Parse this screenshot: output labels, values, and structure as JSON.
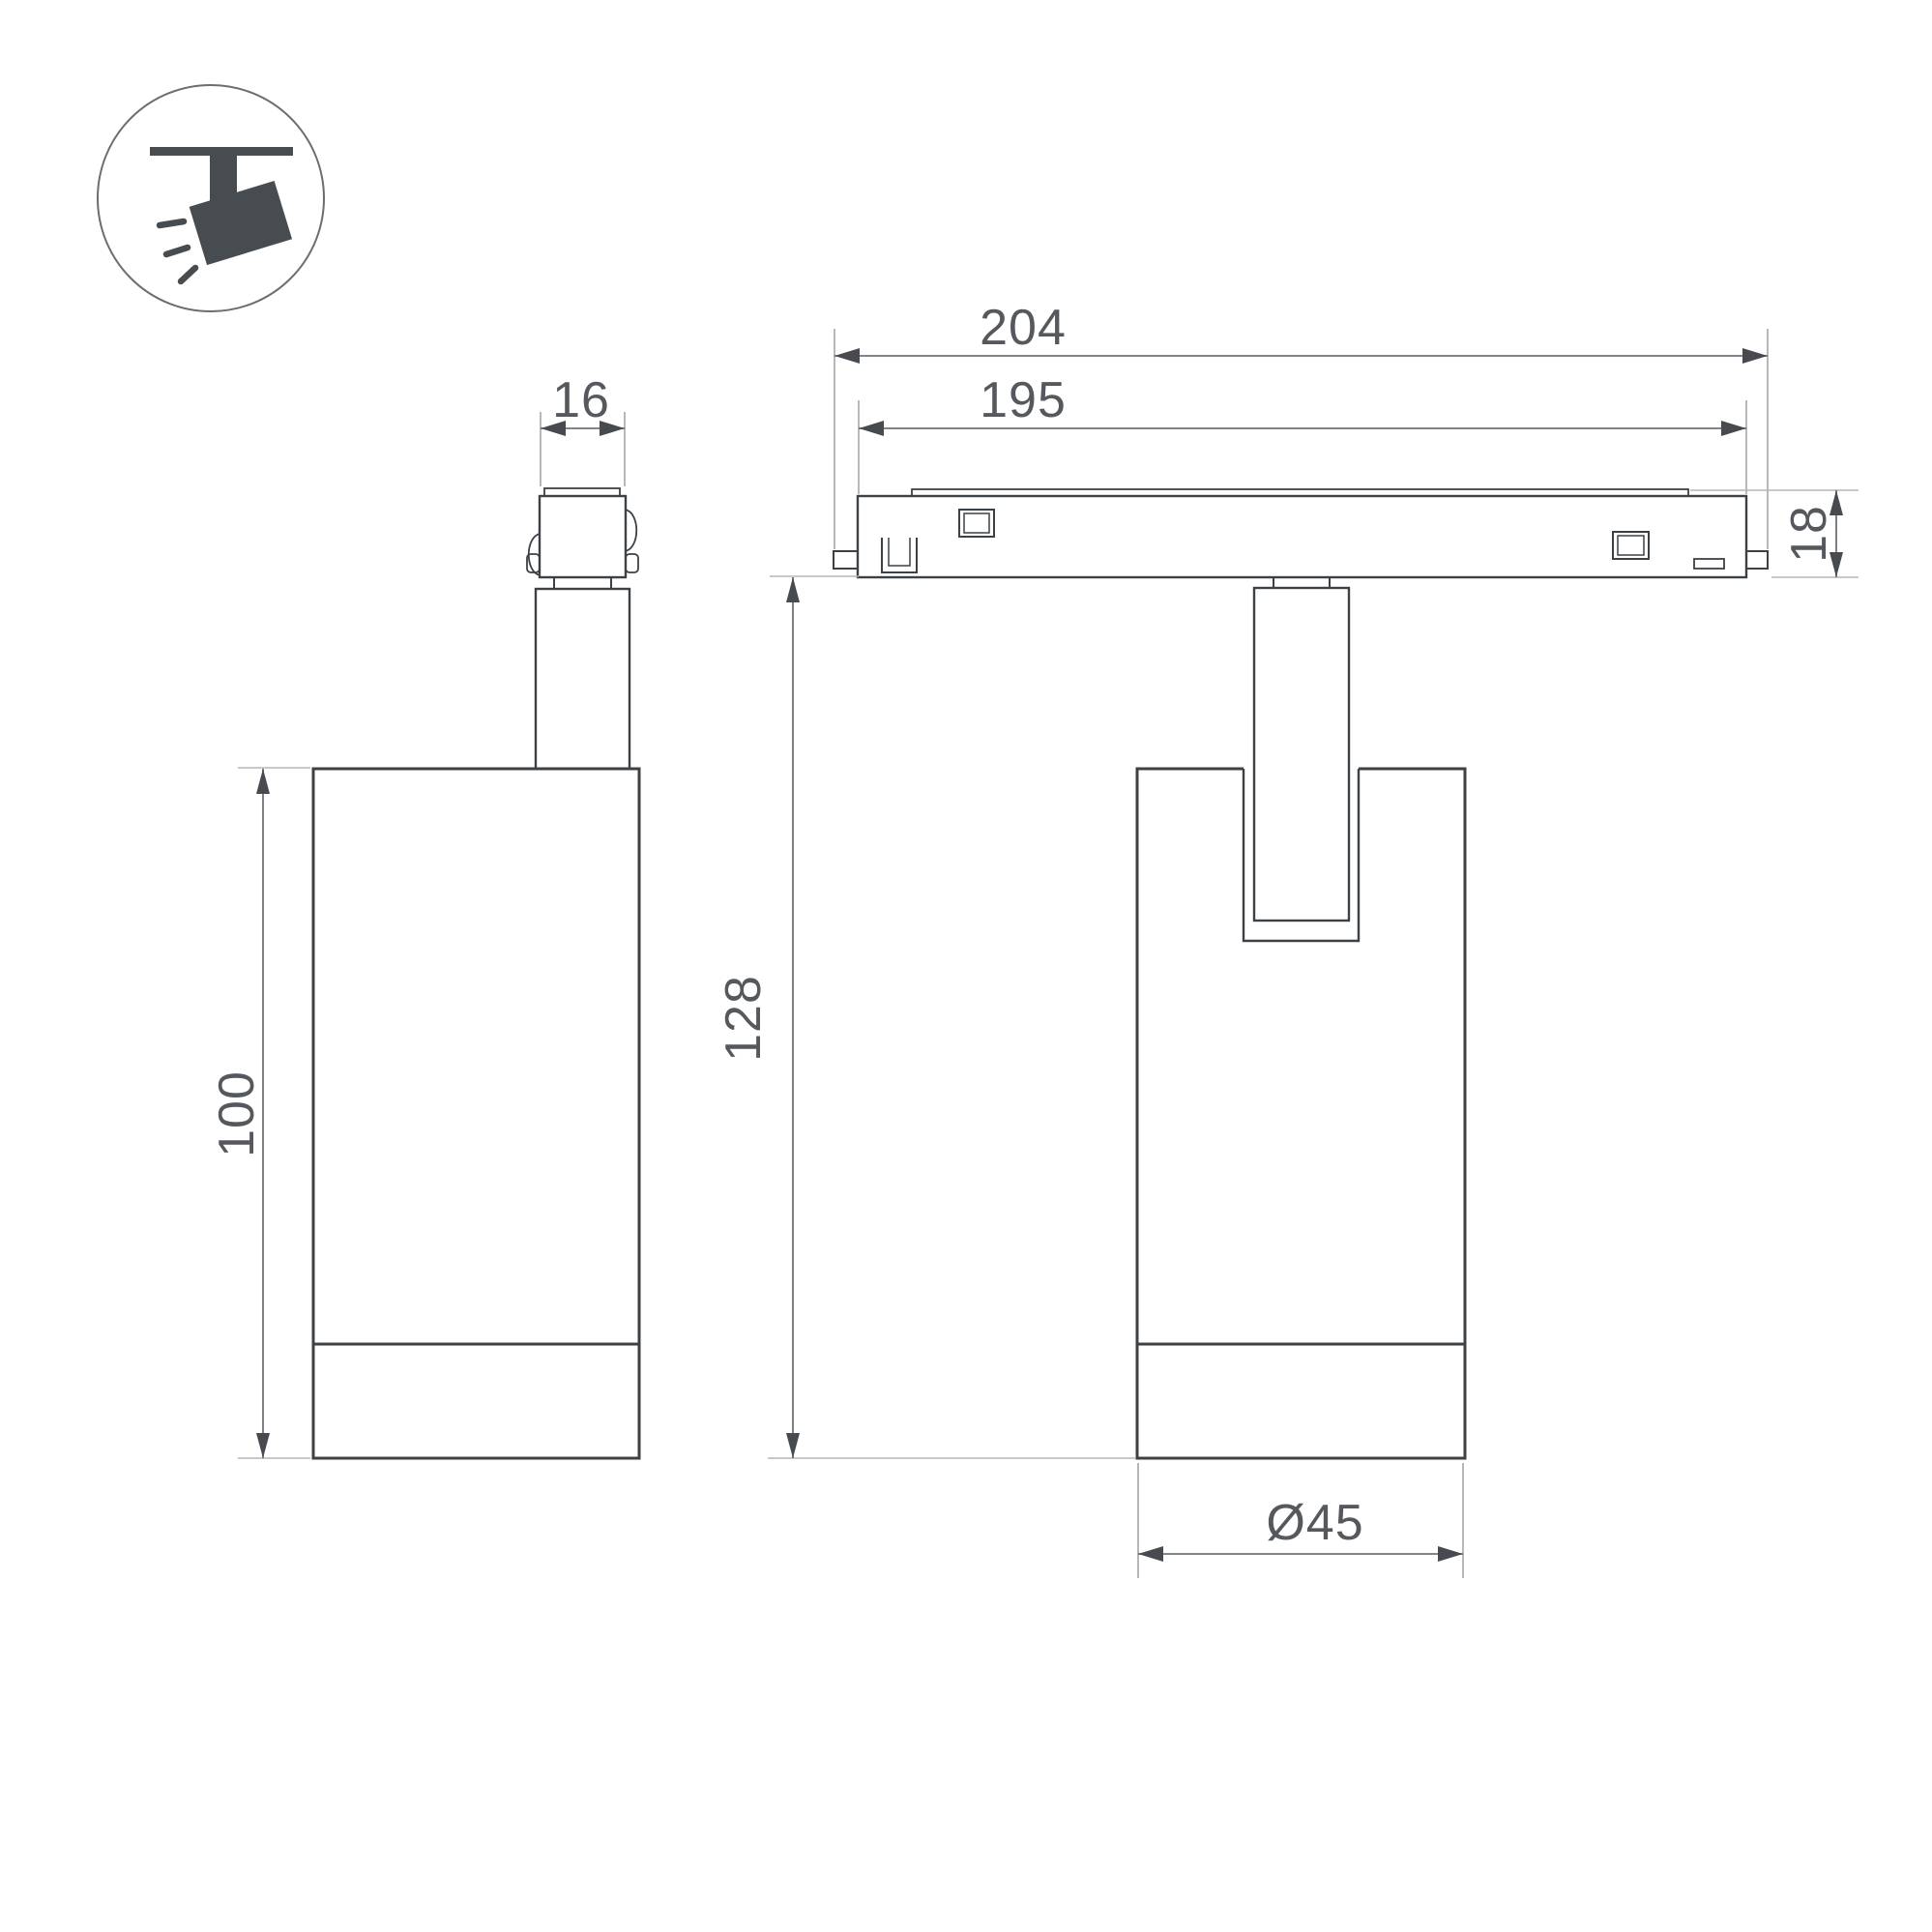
{
  "drawing": {
    "type": "luminaire-dimension-drawing",
    "views": [
      "side-view",
      "front-view-on-track"
    ],
    "units_shown": "mm"
  },
  "icon": {
    "name": "track-spotlight-pictogram",
    "description": "ceiling track with tilted spotlight emitting light rays",
    "glyph_color": "#474c51",
    "circle_color": "#6a6e72"
  },
  "dimensions": {
    "adapter_width": "16",
    "track_outer_length": "204",
    "track_inner_length": "195",
    "track_height": "18",
    "overall_drop_height": "128",
    "body_height": "100",
    "body_diameter": "Ø45"
  },
  "colors": {
    "background": "#ffffff",
    "outline": "#3c4145",
    "dimension_line": "#6e7276",
    "extension_line": "#b3b6b8",
    "arrow": "#474b4f",
    "text": "#55595d"
  }
}
